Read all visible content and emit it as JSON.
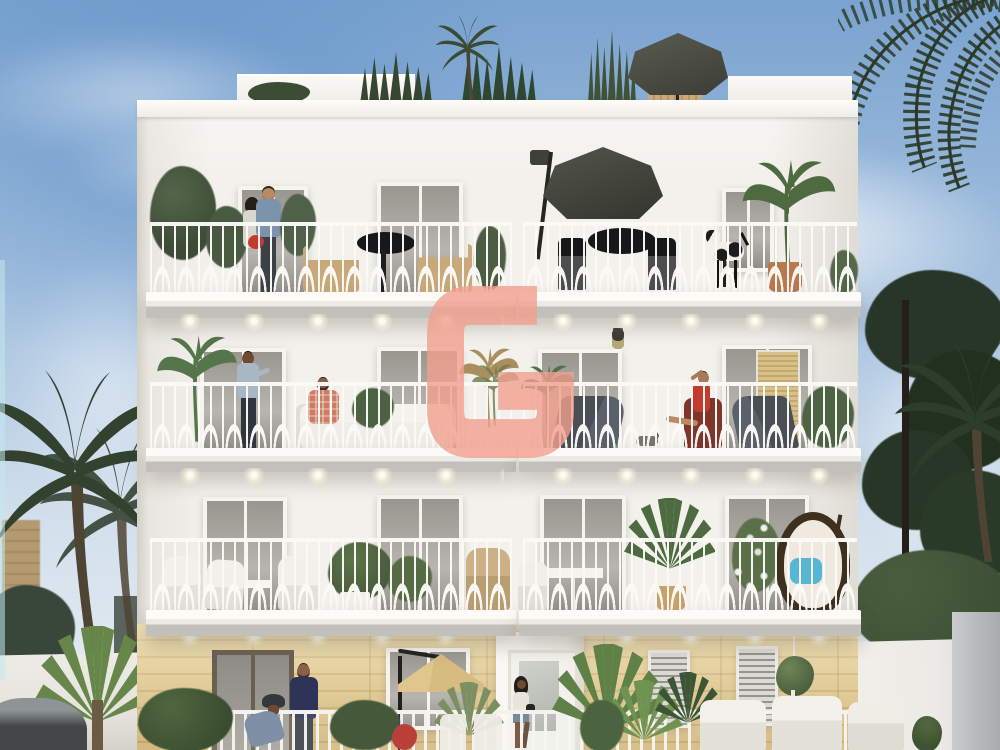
{
  "watermark": {
    "letter": "G",
    "color": "#f2a08f",
    "opacity": 0.8
  },
  "colors": {
    "sky_top": "#7aa3cf",
    "sky_mid": "#a9c4e0",
    "sky_low": "#d3e0ec",
    "sky_haze": "#e9eef3",
    "facade": "#f3f1ec",
    "facade_shade": "#dedbd2",
    "frame": "#f6f4ef",
    "railing": "#fbfaf7",
    "slab_light": "#fcfbf8",
    "slab_dark": "#c2c0ba",
    "stone": "#e3ca90",
    "stone_dark": "#cfb279",
    "palm_dark": "#33422e",
    "palm_mid": "#46583b",
    "palm_bright": "#66864a",
    "pine": "#273627",
    "hedge": "#3e5136",
    "wall_left": "#e6e3dd",
    "wall_right": "#eceae6",
    "wall_shadow": "#a7abae",
    "umbrella_grey": "#4b4c43",
    "umbrella_tan": "#d7bc82",
    "wood": "#c9a87a",
    "red": "#c33a2e",
    "plaid": "#cf7a62",
    "navy": "#2e3457",
    "denim": "#7b93ad",
    "slate": "#7e8fa6",
    "skin": "#b98a63",
    "skin_dark": "#6f4a32",
    "hair": "#241d18",
    "white_furniture": "#efede6",
    "egg_blue": "#57b5d6",
    "egg_wicker": "#3f2f1f",
    "salmon": "#f2a08f",
    "neighbour_tan": "#b39a70",
    "car_grey": "#43474a",
    "black": "#17181a"
  },
  "scene": {
    "setting": "sunny day, blue sky with soft clouds, seaside residential street",
    "building": {
      "style": "white four-storey residence, ornate white balcony railings, recessed downlights under balconies, sandstone ground floor, rooftop terrace",
      "rooftop": [
        "grasses and small palms",
        "grey parasol",
        "wooden lounger"
      ],
      "floors": [
        {
          "name": "third-floor",
          "left_balcony": [
            "green shrubs",
            "embracing couple with red bouquet",
            "small tree",
            "wooden chairs",
            "black bistro table"
          ],
          "right_balcony": [
            "grey cantilever parasol",
            "black table and chairs",
            "standing dog",
            "large potted plant"
          ]
        },
        {
          "name": "second-floor",
          "left_balcony": [
            "banana plant",
            "standing man talking",
            "man in red plaid shirt on white sofa",
            "dried palm plant"
          ],
          "right_balcony": [
            "banana plant",
            "grey loungers",
            "cat",
            "woman in red seated",
            "open timber shutter",
            "potted plants"
          ]
        },
        {
          "name": "first-floor",
          "left_balcony": [
            "white wicker armchairs",
            "round side table",
            "potted green plants",
            "rattan chair"
          ],
          "right_balcony": [
            "white bistro table",
            "tall potted palms",
            "white flowers",
            "hanging egg chair with blue cushion"
          ]
        }
      ],
      "ground_floor": [
        "sandstone banded facade",
        "dark french doors",
        "white entrance door",
        "louvred windows",
        "hanging plant",
        "man in navy sweater",
        "cyclist with helmet",
        "girl walking",
        "tan patio parasol",
        "white garden fence",
        "agaves and palms",
        "seated person in red",
        "white terrace sofas"
      ]
    },
    "surroundings": {
      "left": [
        "tall date palm",
        "second dark palm",
        "bright fan palm",
        "tan neighbouring building",
        "dark hedge",
        "white boundary wall",
        "grey car roof"
      ],
      "right": [
        "overhanging palm fronds",
        "dark pines and palm",
        "leafy hedge",
        "white boundary wall with shaded corner"
      ]
    }
  }
}
